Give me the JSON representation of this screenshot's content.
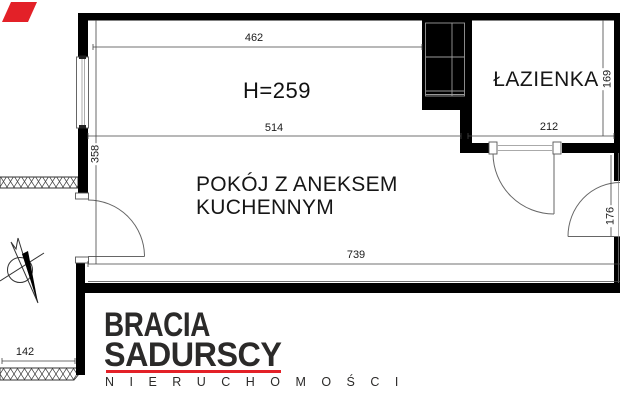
{
  "plan": {
    "room": {
      "label_line1": "POKÓJ Z ANEKSEM",
      "label_line2": "KUCHENNYM",
      "ceiling_height_note": "H=259"
    },
    "bathroom": {
      "label": "ŁAZIENKA"
    },
    "dimensions": {
      "top_wall_width": "462",
      "room_width": "514",
      "bathroom_width": "212",
      "total_bottom_width": "739",
      "room_depth": "358",
      "bathroom_depth": "169",
      "entry_wall_height": "176",
      "corridor_width": "142"
    },
    "colors": {
      "wall": "#000000",
      "line": "#444444"
    }
  },
  "logo": {
    "brand_line1": "BRACIA",
    "brand_line2": "SADURSCY",
    "tagline": "N I E R U C H O M O Ś C I",
    "accent_color": "#e32128",
    "text_color": "#2b2a29"
  }
}
